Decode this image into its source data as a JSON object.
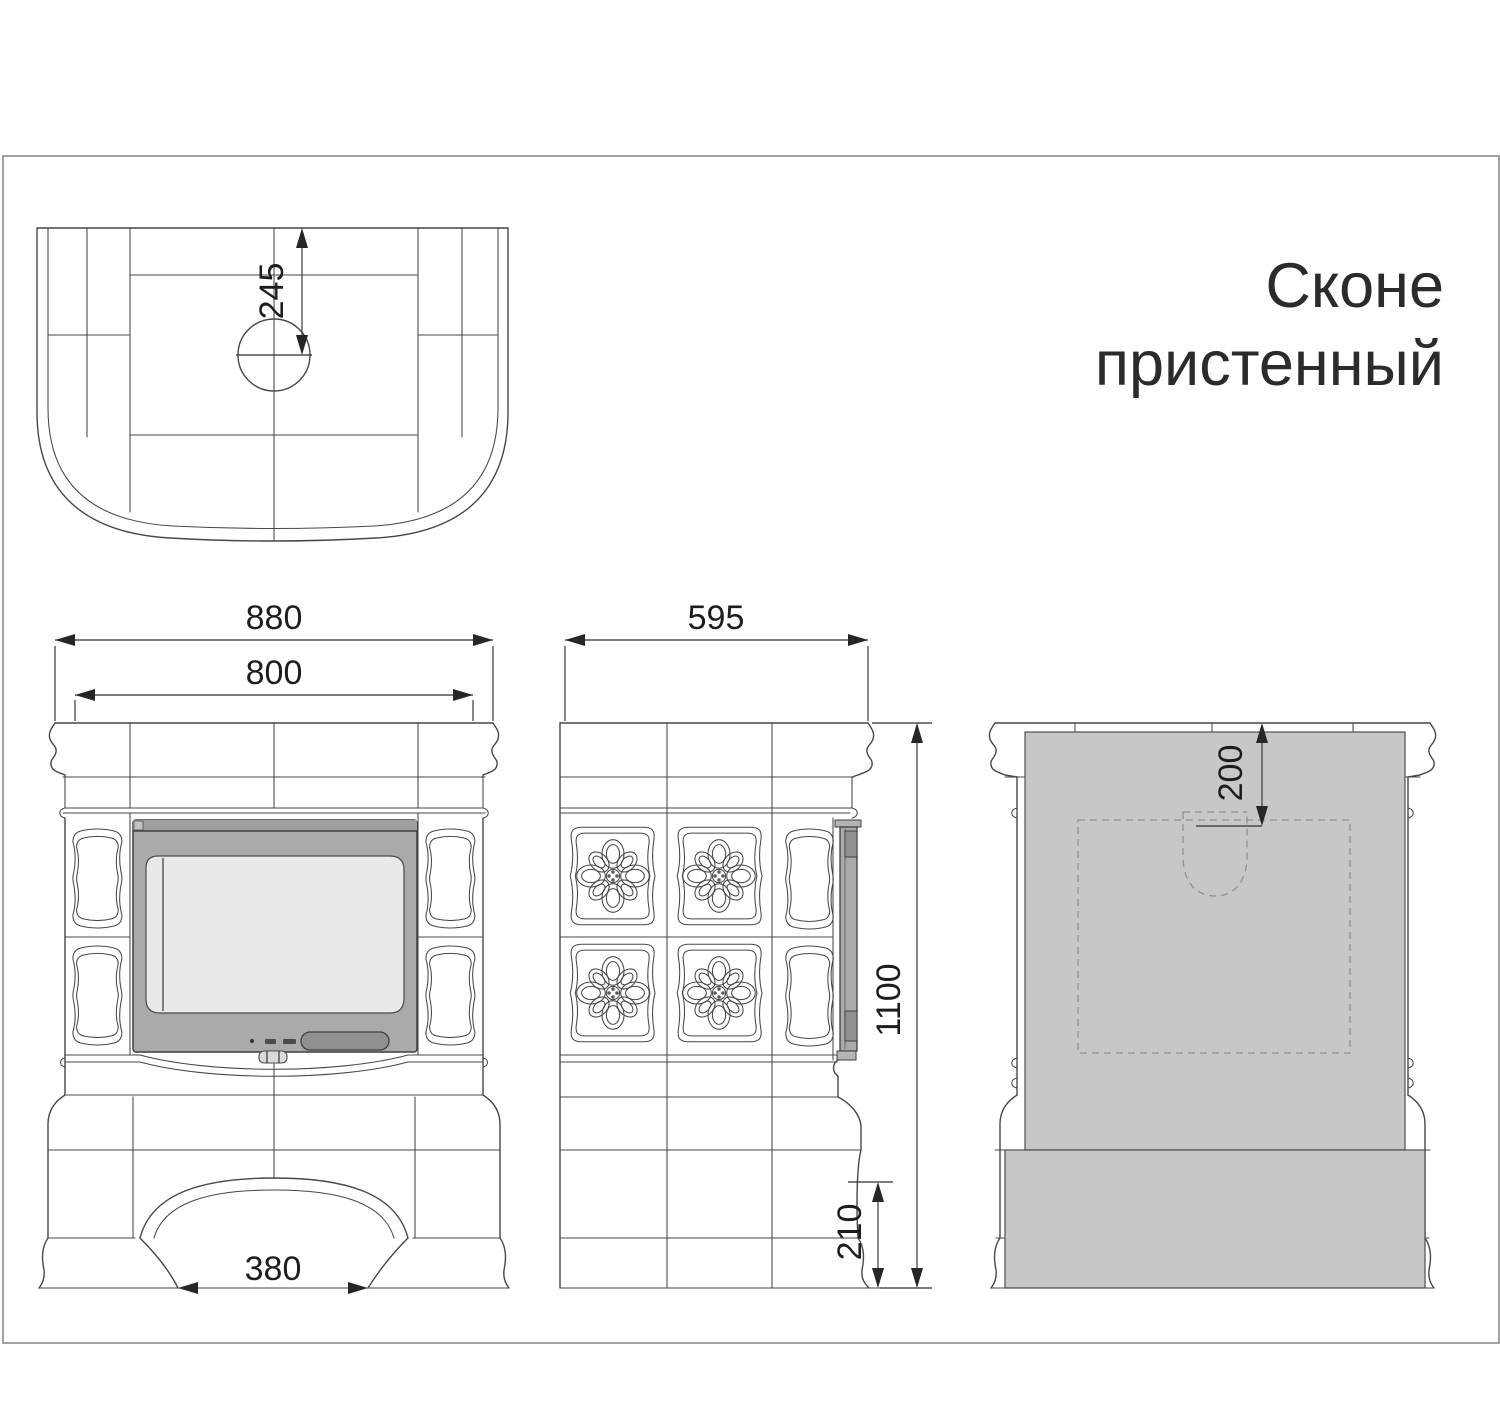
{
  "title": {
    "line1": "Сконе",
    "line2": "пристенный"
  },
  "dimensions": {
    "plan_flue_offset": "245",
    "front_overall_width": "880",
    "front_body_width": "800",
    "front_arch_width": "380",
    "side_depth": "595",
    "side_height": "1100",
    "side_base_height": "210",
    "rear_top_offset": "200"
  },
  "colors": {
    "line": "#474747",
    "door_frame": "#a9aba9",
    "door_glass": "#e9e9e7",
    "door_handle": "#8f9190",
    "heat_shield": "#c6c8c6",
    "frame_border": "#8a8a8a",
    "background": "#ffffff"
  }
}
